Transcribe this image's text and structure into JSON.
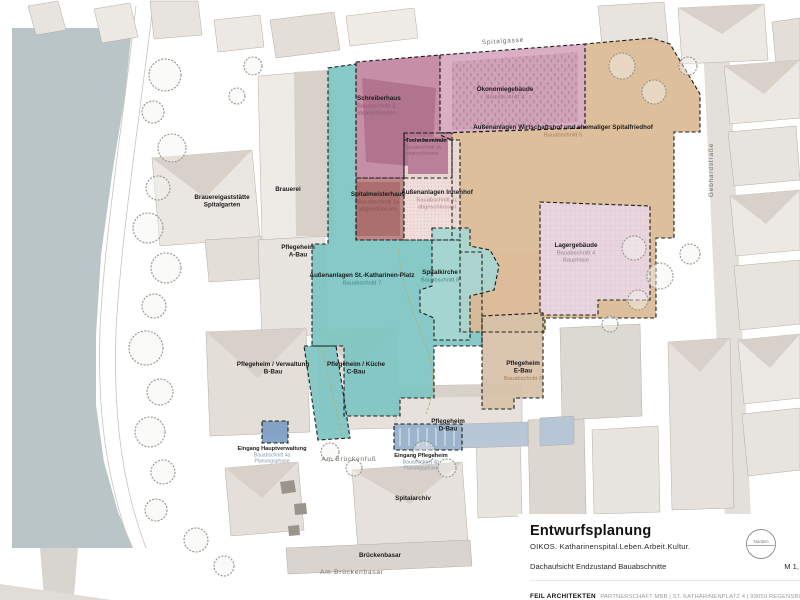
{
  "colors": {
    "river": "#b9c5c6",
    "zone_border": "#1c1c1c",
    "path_accent": "#b5ae6e"
  },
  "streets": [
    {
      "id": "spitalgasse",
      "label": "Spitalgasse"
    },
    {
      "id": "gebhardstrasse",
      "label": "Gebhardstraße"
    },
    {
      "id": "am_brueckenfuss",
      "label": "Am Brückenfuß"
    },
    {
      "id": "am_brueckenbasar",
      "label": "Am Brückenbasar"
    }
  ],
  "zones": [
    {
      "id": "katharinen",
      "title_lines": [
        "Außenanlagen St.-Katharinen-Platz"
      ],
      "sub_lines": [
        "Bauabschnitt 7"
      ],
      "color": "#7dc5c2",
      "sub_color": "#3f8a87"
    },
    {
      "id": "schreiberhaus",
      "title_lines": [
        "Schreiberhaus"
      ],
      "sub_lines": [
        "Bauabschnitt 2",
        "abgeschlossen"
      ],
      "color": "#c286a0",
      "sub_color": "#8f5a72"
    },
    {
      "id": "oekonomie",
      "title_lines": [
        "Ökonomiegebäude"
      ],
      "sub_lines": [
        "Bauabschnitt 3"
      ],
      "color": "#d7a9be",
      "sub_color": "#a06f88"
    },
    {
      "id": "wirtschaftshof",
      "title_lines": [
        "Außenanlagen Wirtschaftshof und ehemaliger Spitalfriedhof"
      ],
      "sub_lines": [
        "Bauabschnitt 5"
      ],
      "color": "#dcba95",
      "sub_color": "#a3805b"
    },
    {
      "id": "technik",
      "title_lines": [
        "Technikzentrale"
      ],
      "sub_lines": [
        "Bauabschnitt 1b",
        "abgeschlossen"
      ],
      "color": "#c68da5",
      "sub_color": "#8f5a72"
    },
    {
      "id": "spitalmeister",
      "title_lines": [
        "Spitalmeisterhaus"
      ],
      "sub_lines": [
        "Bauabschnitt 1a",
        "abgeschlossen"
      ],
      "color": "#b97f7f",
      "sub_color": "#8a5252"
    },
    {
      "id": "innenhof",
      "title_lines": [
        "Außenanlagen Innenhof"
      ],
      "sub_lines": [
        "Bauabschnitt 1c",
        "abgeschlossen"
      ],
      "color": "#efdbd8",
      "sub_color": "#b18a8a"
    },
    {
      "id": "kirche",
      "title_lines": [
        "Spitalkirche"
      ],
      "sub_lines": [
        "Bauabschnitt 8"
      ],
      "color": "#a8d6d2",
      "sub_color": "#3f8a87"
    },
    {
      "id": "lager",
      "title_lines": [
        "Lagergebäude"
      ],
      "sub_lines": [
        "Bauabschnitt 4",
        "Bauphase"
      ],
      "color": "#e9d6e2",
      "sub_color": "#9a7f94"
    },
    {
      "id": "ebau",
      "title_lines": [
        "Pflegeheim",
        "E-Bau"
      ],
      "sub_lines": [
        "Bauabschnitt 6"
      ],
      "color": "#d7c2a8",
      "sub_color": "#a3805b"
    },
    {
      "id": "eingang_haupt",
      "title_lines": [
        "Eingang Hauptverwaltung"
      ],
      "sub_lines": [
        "Bauabschnitt 4a",
        "Planungsphase"
      ],
      "color": "#7d9ec2",
      "sub_color": "#8298b0"
    },
    {
      "id": "eingang_pflege",
      "title_lines": [
        "Eingang Pflegeheim"
      ],
      "sub_lines": [
        "Bauabschnitt 4b",
        "Planungsphase"
      ],
      "color": "#94afc9",
      "sub_color": "#8298b0"
    }
  ],
  "building_labels": [
    {
      "id": "brauereigaststaette",
      "lines": [
        "Brauereigaststätte",
        "Spitalgarten"
      ]
    },
    {
      "id": "brauerei",
      "lines": [
        "Brauerei"
      ]
    },
    {
      "id": "abau",
      "lines": [
        "Pflegeheim",
        "A-Bau"
      ]
    },
    {
      "id": "bbau",
      "lines": [
        "Pflegeheim / Verwaltung",
        "B-Bau"
      ]
    },
    {
      "id": "cbau",
      "lines": [
        "Pflegeheim / Küche",
        "C-Bau"
      ]
    },
    {
      "id": "dbau",
      "lines": [
        "Pflegeheim",
        "D-Bau"
      ]
    },
    {
      "id": "spitalarchiv",
      "lines": [
        "Spitalarchiv"
      ]
    },
    {
      "id": "brueckenbasar",
      "lines": [
        "Brückenbasar"
      ]
    }
  ],
  "title_block": {
    "title": "Entwurfsplanung",
    "subtitle": "OIKOS. Katharinenspital.Leben.Arbeit.Kultur.",
    "drawing_name": "Dachaufsicht Endzustand Bauabschnitte",
    "scale": "M 1,",
    "firm": "FEIL ARCHITEKTEN",
    "firm_details": "PARTNERSCHAFT MBB | ST. KATHARINENPLATZ 4 | 93059 REGENSBURG | 05.02.202",
    "north_label": "Norden"
  }
}
